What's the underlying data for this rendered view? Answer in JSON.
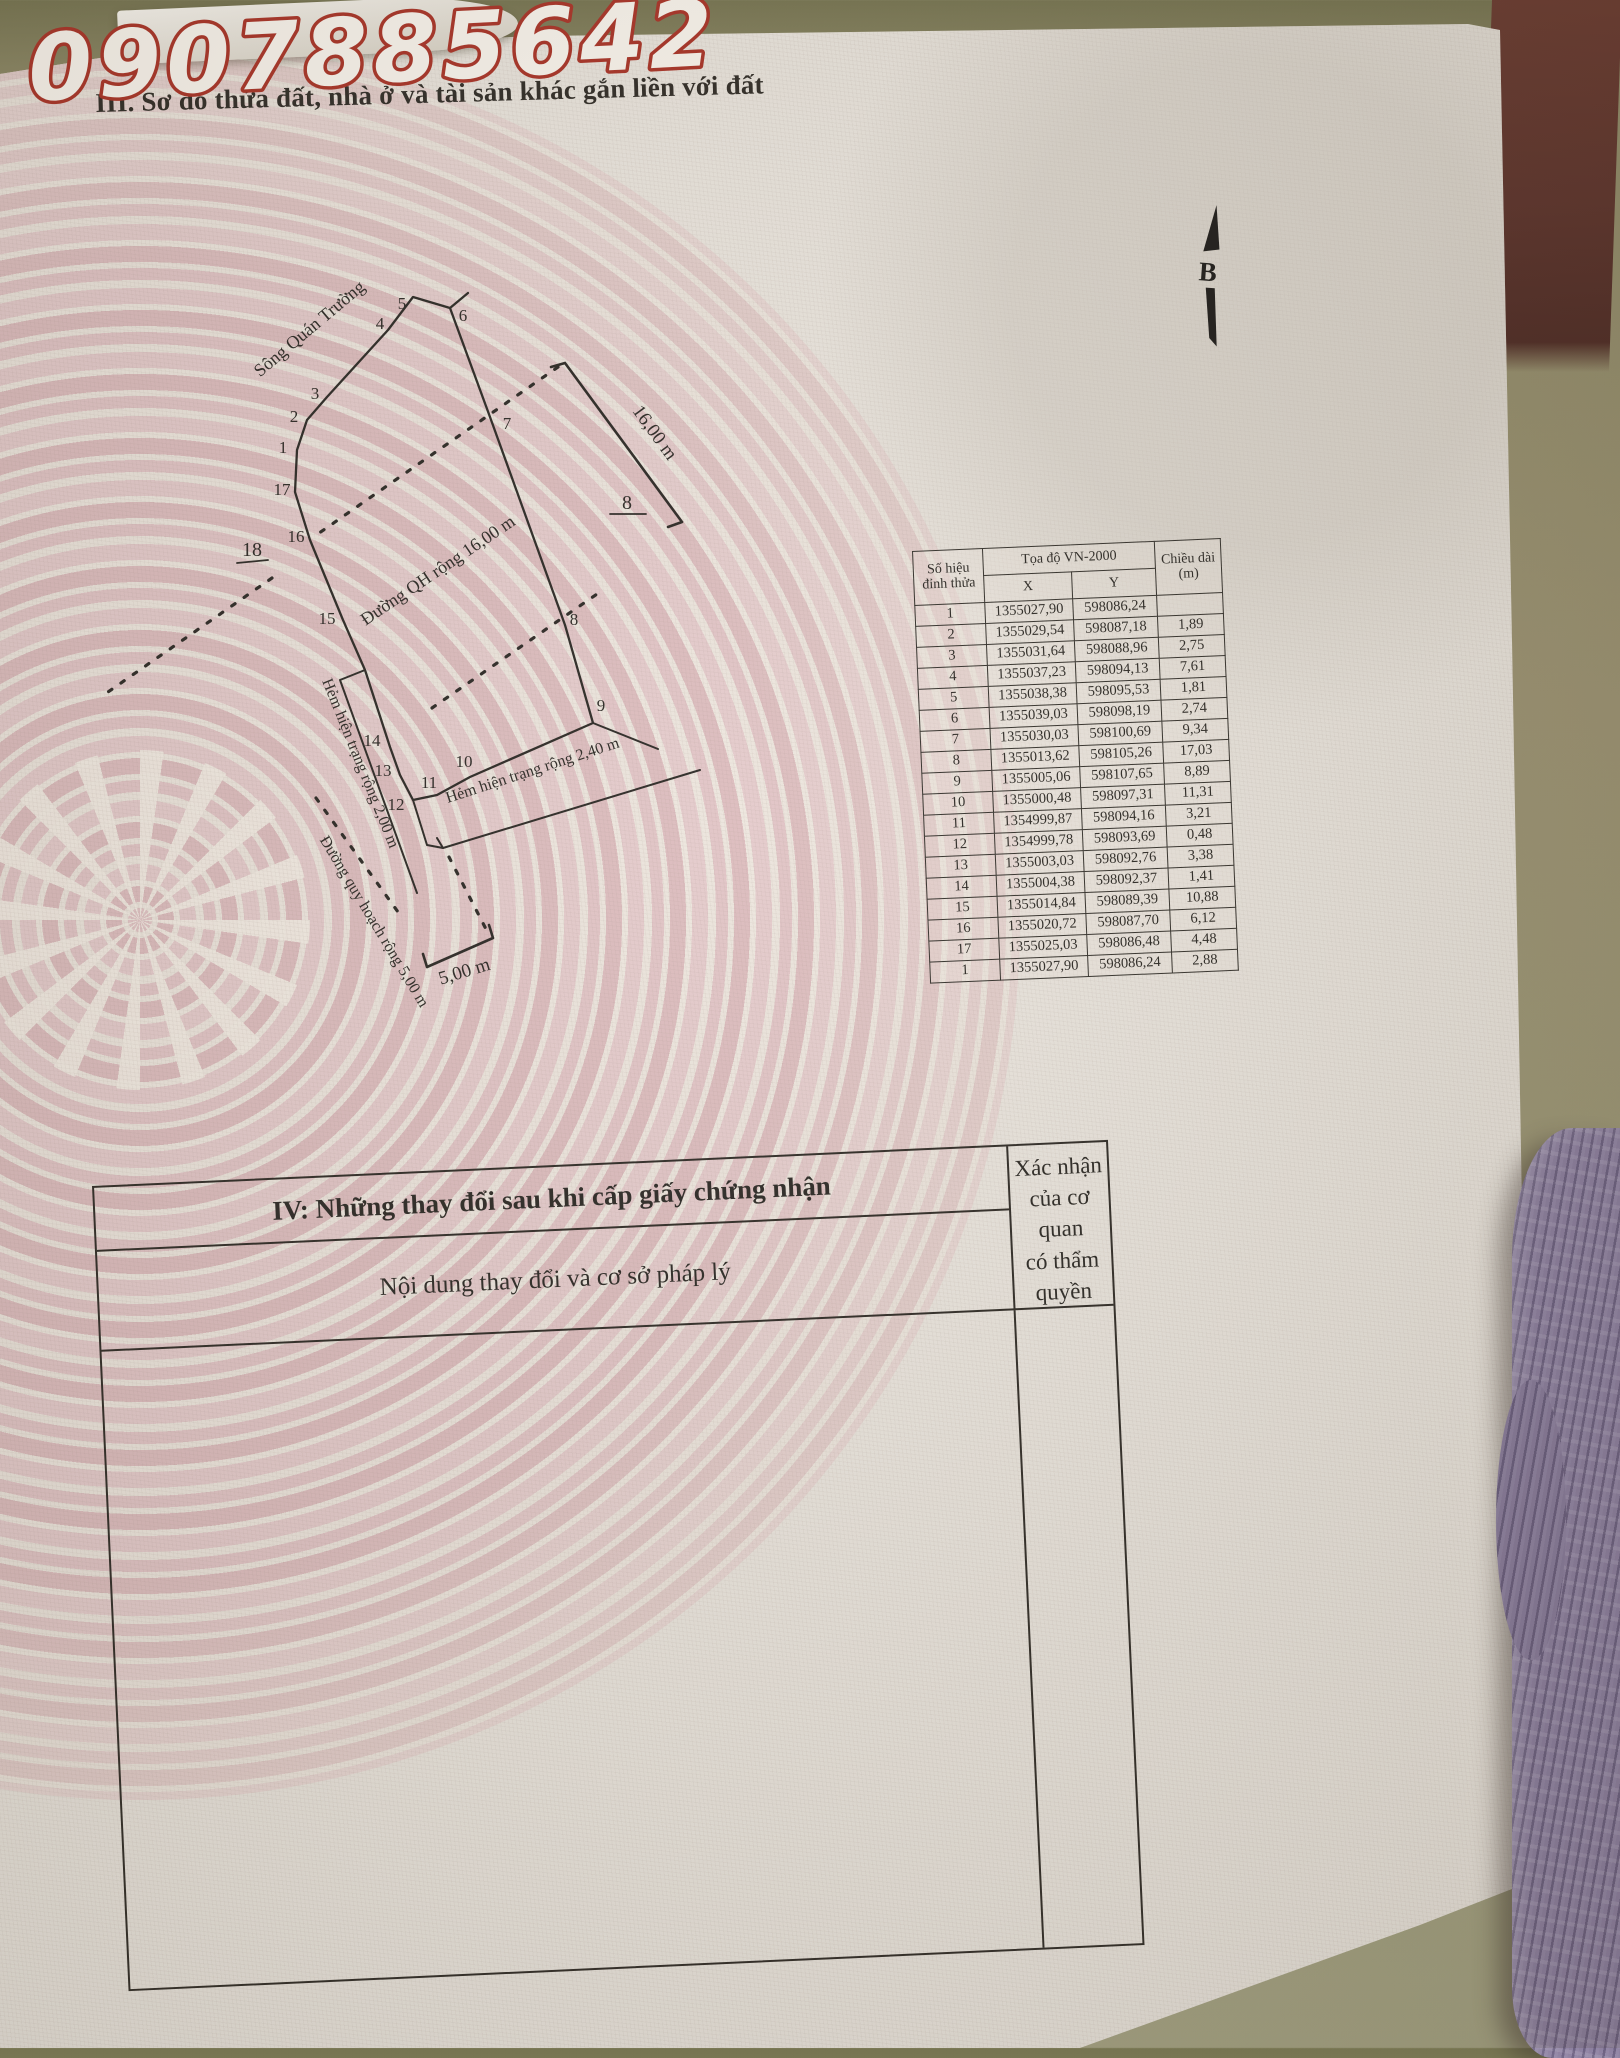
{
  "photo": {
    "phone_watermark": "0907885642"
  },
  "section3": {
    "title": "III. Sơ đồ thửa đất, nhà ở và tài sản khác gắn liền với đất"
  },
  "compass": {
    "north_label": "B"
  },
  "diagram": {
    "labels": {
      "river": "Sông Quán Trường",
      "qh_road": "Đường QH rộng 16,00 m",
      "alley_200": "Hẻm hiện trạng rộng 2,00 m",
      "alley_240": "Hẻm hiện trạng rộng 2,40 m",
      "plan_road": "Đường quy hoạch rộng 5,00 m",
      "dim_16": "16,00 m",
      "dim_5": "5,00 m",
      "adjacent_parcel_18": "18",
      "adjacent_parcel_8": "8"
    },
    "vertex_labels": [
      "1",
      "2",
      "3",
      "4",
      "5",
      "6",
      "7",
      "8",
      "9",
      "10",
      "11",
      "12",
      "13",
      "14",
      "15",
      "16",
      "17"
    ]
  },
  "coord_table": {
    "header": {
      "col_vertex": "Số hiệu đỉnh thửa",
      "col_coord": "Tọa độ VN-2000",
      "col_x": "X",
      "col_y": "Y",
      "col_len": "Chiều dài (m)"
    },
    "rows": [
      {
        "v": "1",
        "x": "1355027,90",
        "y": "598086,24",
        "d": ""
      },
      {
        "v": "2",
        "x": "1355029,54",
        "y": "598087,18",
        "d": "1,89"
      },
      {
        "v": "3",
        "x": "1355031,64",
        "y": "598088,96",
        "d": "2,75"
      },
      {
        "v": "4",
        "x": "1355037,23",
        "y": "598094,13",
        "d": "7,61"
      },
      {
        "v": "5",
        "x": "1355038,38",
        "y": "598095,53",
        "d": "1,81"
      },
      {
        "v": "6",
        "x": "1355039,03",
        "y": "598098,19",
        "d": "2,74"
      },
      {
        "v": "7",
        "x": "1355030,03",
        "y": "598100,69",
        "d": "9,34"
      },
      {
        "v": "8",
        "x": "1355013,62",
        "y": "598105,26",
        "d": "17,03"
      },
      {
        "v": "9",
        "x": "1355005,06",
        "y": "598107,65",
        "d": "8,89"
      },
      {
        "v": "10",
        "x": "1355000,48",
        "y": "598097,31",
        "d": "11,31"
      },
      {
        "v": "11",
        "x": "1354999,87",
        "y": "598094,16",
        "d": "3,21"
      },
      {
        "v": "12",
        "x": "1354999,78",
        "y": "598093,69",
        "d": "0,48"
      },
      {
        "v": "13",
        "x": "1355003,03",
        "y": "598092,76",
        "d": "3,38"
      },
      {
        "v": "14",
        "x": "1355004,38",
        "y": "598092,37",
        "d": "1,41"
      },
      {
        "v": "15",
        "x": "1355014,84",
        "y": "598089,39",
        "d": "10,88"
      },
      {
        "v": "16",
        "x": "1355020,72",
        "y": "598087,70",
        "d": "6,12"
      },
      {
        "v": "17",
        "x": "1355025,03",
        "y": "598086,48",
        "d": "4,48"
      },
      {
        "v": "1",
        "x": "1355027,90",
        "y": "598086,24",
        "d": "2,88"
      }
    ]
  },
  "section4": {
    "title": "IV: Những thay đổi sau khi cấp giấy chứng nhận",
    "left_header": "Nội dung thay đổi và cơ sở pháp lý",
    "right_header_line1": "Xác nhận của cơ quan",
    "right_header_line2": "có thẩm quyền"
  },
  "colors": {
    "paper": "#eae5de",
    "ink": "#2c2925",
    "drum_pink": "#dcb6ba",
    "watermark_red": "#a93226",
    "wall_tan": "#9b9272",
    "dark_band_maroon": "#5c322b",
    "knit_purple": "#8b7e9f"
  }
}
